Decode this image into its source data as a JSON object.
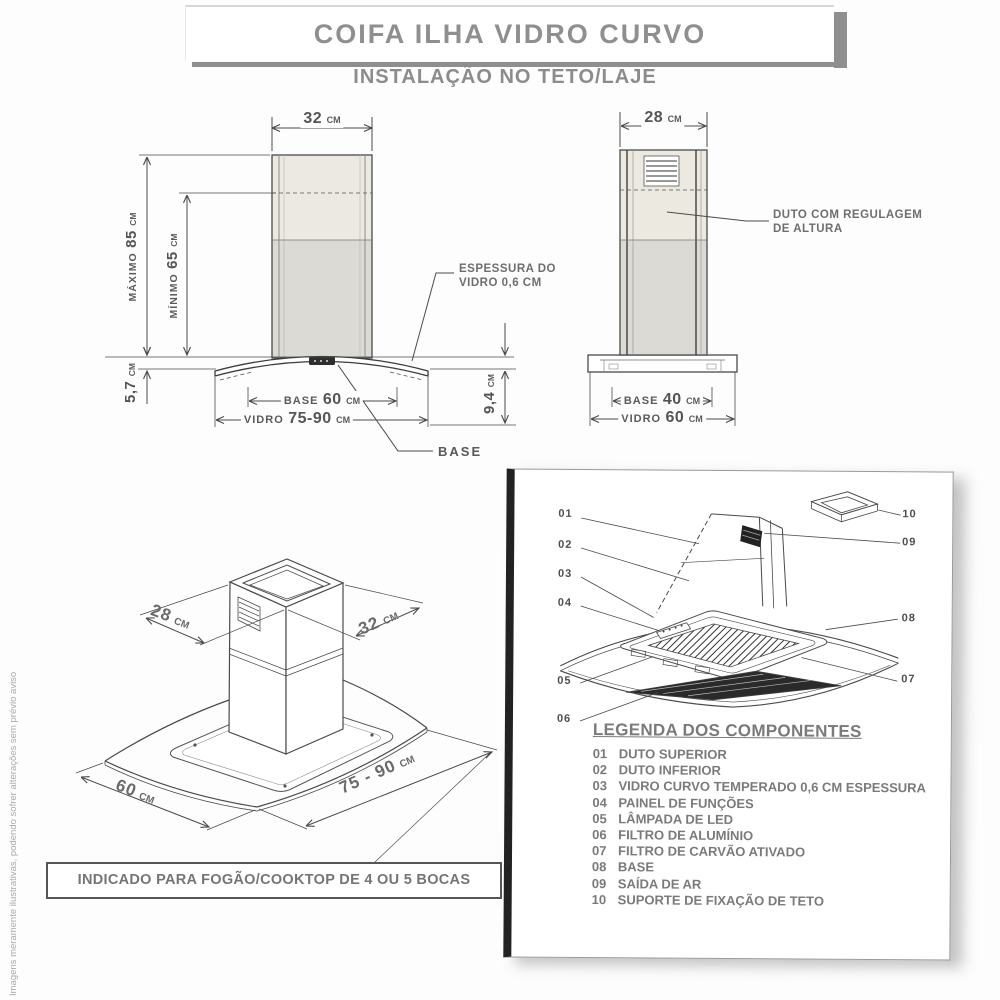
{
  "header": {
    "title": "COIFA ILHA VIDRO CURVO",
    "subtitle": "INSTALAÇÃO NO TETO/LAJE"
  },
  "front_view": {
    "top_width": {
      "value": "32",
      "unit": "CM"
    },
    "max_height": {
      "label": "MÁXIMO",
      "value": "85",
      "unit": "CM"
    },
    "min_height": {
      "label": "MÍNIMO",
      "value": "65",
      "unit": "CM"
    },
    "chimney_overlap": {
      "value": "5,7",
      "unit": "CM"
    },
    "glass_drop": {
      "value": "9,4",
      "unit": "CM"
    },
    "base_width": {
      "label": "BASE",
      "value": "60",
      "unit": "CM"
    },
    "glass_width": {
      "label": "VIDRO",
      "value": "75-90",
      "unit": "CM"
    },
    "glass_thickness_note_line1": "ESPESSURA DO",
    "glass_thickness_note_line2": "VIDRO 0,6 CM",
    "base_callout": "BASE"
  },
  "side_view": {
    "top_width": {
      "value": "28",
      "unit": "CM"
    },
    "duct_note_line1": "DUTO COM REGULAGEM",
    "duct_note_line2": "DE ALTURA",
    "base_width": {
      "label": "BASE",
      "value": "40",
      "unit": "CM"
    },
    "glass_width": {
      "label": "VIDRO",
      "value": "60",
      "unit": "CM"
    }
  },
  "iso_view": {
    "depth": {
      "value": "28",
      "unit": "CM"
    },
    "width": {
      "value": "32",
      "unit": "CM"
    },
    "glass_depth": {
      "value": "60",
      "unit": "CM"
    },
    "glass_width": {
      "value": "75 - 90",
      "unit": "CM"
    }
  },
  "note_box": {
    "text": "INDICADO PARA FOGÃO/COOKTOP DE 4 OU 5 BOCAS"
  },
  "exploded_panel": {
    "callouts": [
      "01",
      "02",
      "03",
      "04",
      "05",
      "06",
      "07",
      "08",
      "09",
      "10"
    ],
    "legend_title": "LEGENDA DOS COMPONENTES",
    "legend_items": [
      {
        "num": "01",
        "name": "DUTO SUPERIOR"
      },
      {
        "num": "02",
        "name": "DUTO INFERIOR"
      },
      {
        "num": "03",
        "name": "VIDRO CURVO TEMPERADO 0,6 CM ESPESSURA"
      },
      {
        "num": "04",
        "name": "PAINEL DE FUNÇÕES"
      },
      {
        "num": "05",
        "name": "LÂMPADA DE LED"
      },
      {
        "num": "06",
        "name": "FILTRO DE ALUMÍNIO"
      },
      {
        "num": "07",
        "name": "FILTRO DE CARVÃO ATIVADO"
      },
      {
        "num": "08",
        "name": "BASE"
      },
      {
        "num": "09",
        "name": "SAÍDA DE AR"
      },
      {
        "num": "10",
        "name": "SUPORTE DE FIXAÇÃO DE TETO"
      }
    ]
  },
  "footer": {
    "disclaimer": "Imagens meramente ilustrativas, podendo sofrer alterações sem prévio aviso"
  },
  "colors": {
    "line": "#4a4a4a",
    "heading_gray": "#8f8f8f",
    "duct_upper_fill": "#ebe9e2",
    "duct_lower_fill": "#dbdad5"
  }
}
